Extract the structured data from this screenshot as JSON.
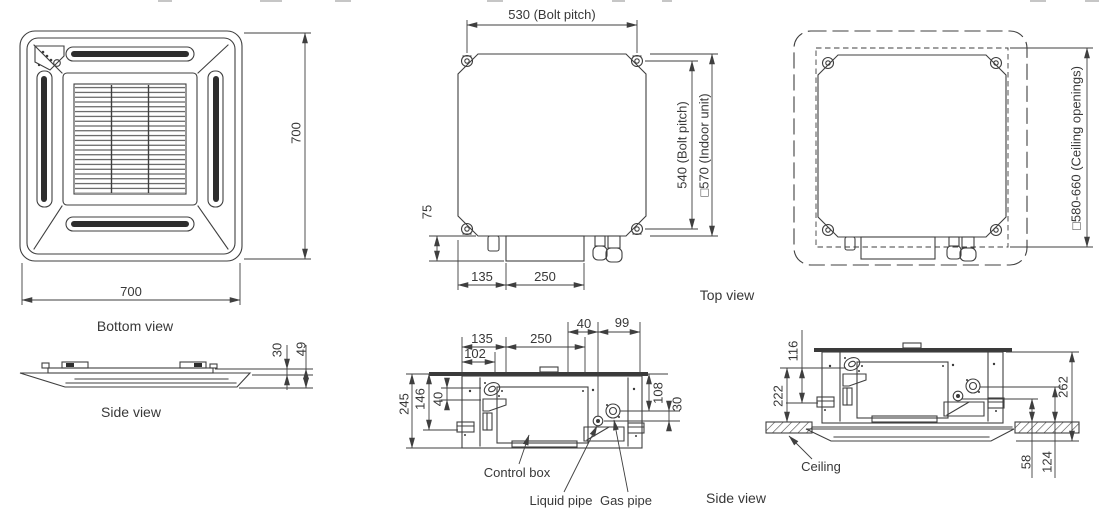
{
  "colors": {
    "line": "#3f3f3f",
    "dark_fill": "#2e2e2e",
    "background": "#ffffff"
  },
  "bottom_view": {
    "caption": "Bottom view",
    "dim_width": "700",
    "dim_height": "700"
  },
  "panel_side_view": {
    "caption": "Side view",
    "dim_panel_height": "30",
    "dim_total_height": "49"
  },
  "top_view": {
    "caption": "Top view",
    "dim_bolt_pitch_h": "530 (Bolt pitch)",
    "dim_bolt_pitch_v": "540 (Bolt pitch)",
    "dim_indoor_unit": "□570 (Indoor unit)",
    "dim_drain_75": "75",
    "dim_135": "135",
    "dim_250": "250"
  },
  "ceiling_view": {
    "dim_ceiling_openings": "□580-660 (Ceiling openings)"
  },
  "unit_side_view": {
    "caption": "Side view",
    "dim_135": "135",
    "dim_250": "250",
    "dim_102": "102",
    "dim_40_top": "40",
    "dim_99": "99",
    "dim_245": "245",
    "dim_146": "146",
    "dim_40_left": "40",
    "dim_108": "108",
    "dim_30": "30",
    "label_control_box": "Control box",
    "label_liquid_pipe": "Liquid pipe",
    "label_gas_pipe": "Gas pipe"
  },
  "installed_side_view": {
    "dim_116": "116",
    "dim_222": "222",
    "dim_262": "262",
    "dim_58": "58",
    "dim_124": "124",
    "label_ceiling": "Ceiling"
  }
}
